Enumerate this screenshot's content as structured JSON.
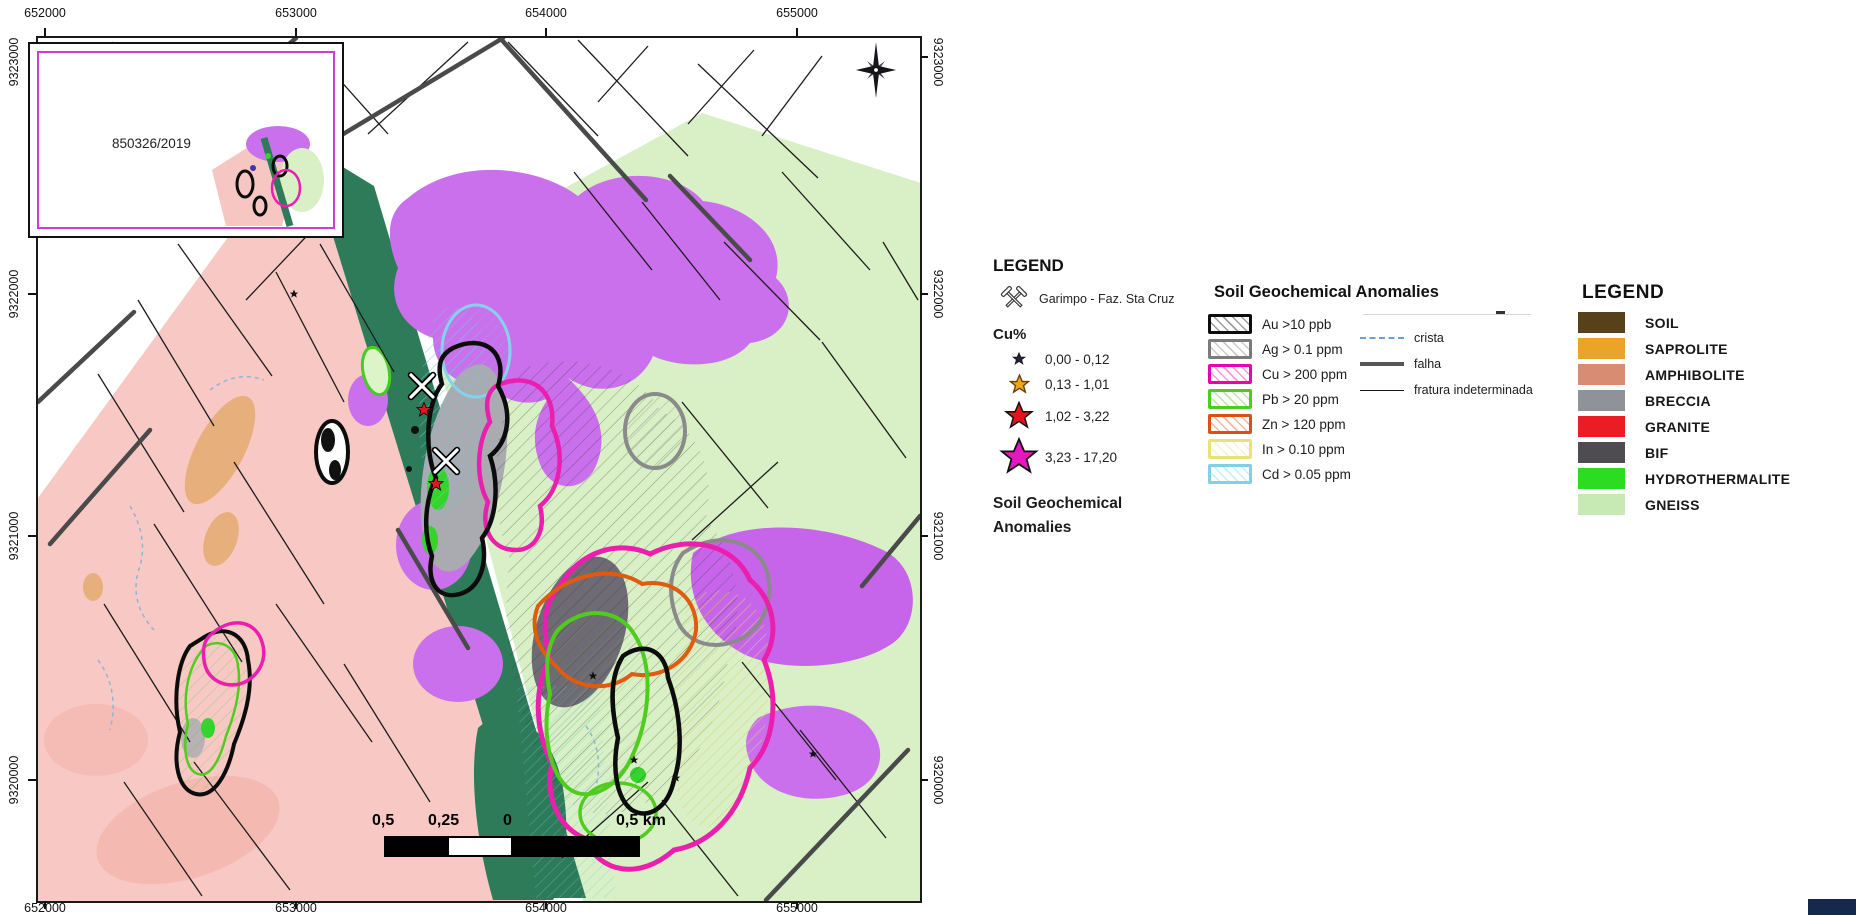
{
  "map": {
    "x_ticks": [
      "652000",
      "653000",
      "654000",
      "655000"
    ],
    "y_ticks": [
      "9323000",
      "9322000",
      "9321000",
      "9320000"
    ],
    "inset_label": "850326/2019",
    "scale_labels": [
      "0,5",
      "0,25",
      "0",
      "0,5 km"
    ]
  },
  "legend_site": {
    "title": "LEGEND",
    "garimpo_label": "Garimpo - Faz. Sta Cruz",
    "cu_title": "Cu%",
    "cu_classes": [
      {
        "label": "0,00 - 0,12",
        "color": "#26203a"
      },
      {
        "label": "0,13 - 1,01",
        "color": "#efa517"
      },
      {
        "label": "1,02 - 3,22",
        "color": "#e6131f"
      },
      {
        "label": "3,23 - 17,20",
        "color": "#e617c0"
      }
    ],
    "footer_line1": "Soil Geochemical",
    "footer_line2": "Anomalies"
  },
  "legend_anomalies": {
    "title": "Soil Geochemical Anomalies",
    "items": [
      {
        "label": "Au >10 ppb",
        "color": "#0d0d0d"
      },
      {
        "label": "Ag > 0.1 ppm",
        "color": "#7b7b7b"
      },
      {
        "label": "Cu > 200 ppm",
        "color": "#ea00b0"
      },
      {
        "label": "Pb > 20 ppm",
        "color": "#4ecb1e"
      },
      {
        "label": "Zn > 120 ppm",
        "color": "#dd4f12"
      },
      {
        "label": "In > 0.10 ppm",
        "color": "#e8e27a"
      },
      {
        "label": "Cd > 0.05 ppm",
        "color": "#7fd0e8"
      }
    ],
    "lines": [
      {
        "label": "crista"
      },
      {
        "label": "falha"
      },
      {
        "label": "fratura indeterminada"
      }
    ]
  },
  "legend_lithology": {
    "title": "LEGEND",
    "items": [
      {
        "label": "SOIL",
        "color": "#57411a"
      },
      {
        "label": "SAPROLITE",
        "color": "#eaa42a"
      },
      {
        "label": "AMPHIBOLITE",
        "color": "#d88d73"
      },
      {
        "label": "BRECCIA",
        "color": "#8f9399"
      },
      {
        "label": "GRANITE",
        "color": "#ec1c24"
      },
      {
        "label": "BIF",
        "color": "#4e4b51"
      },
      {
        "label": "HYDROTHERMALITE",
        "color": "#2bdc21"
      },
      {
        "label": "GNEISS",
        "color": "#c7e9b3"
      }
    ]
  }
}
